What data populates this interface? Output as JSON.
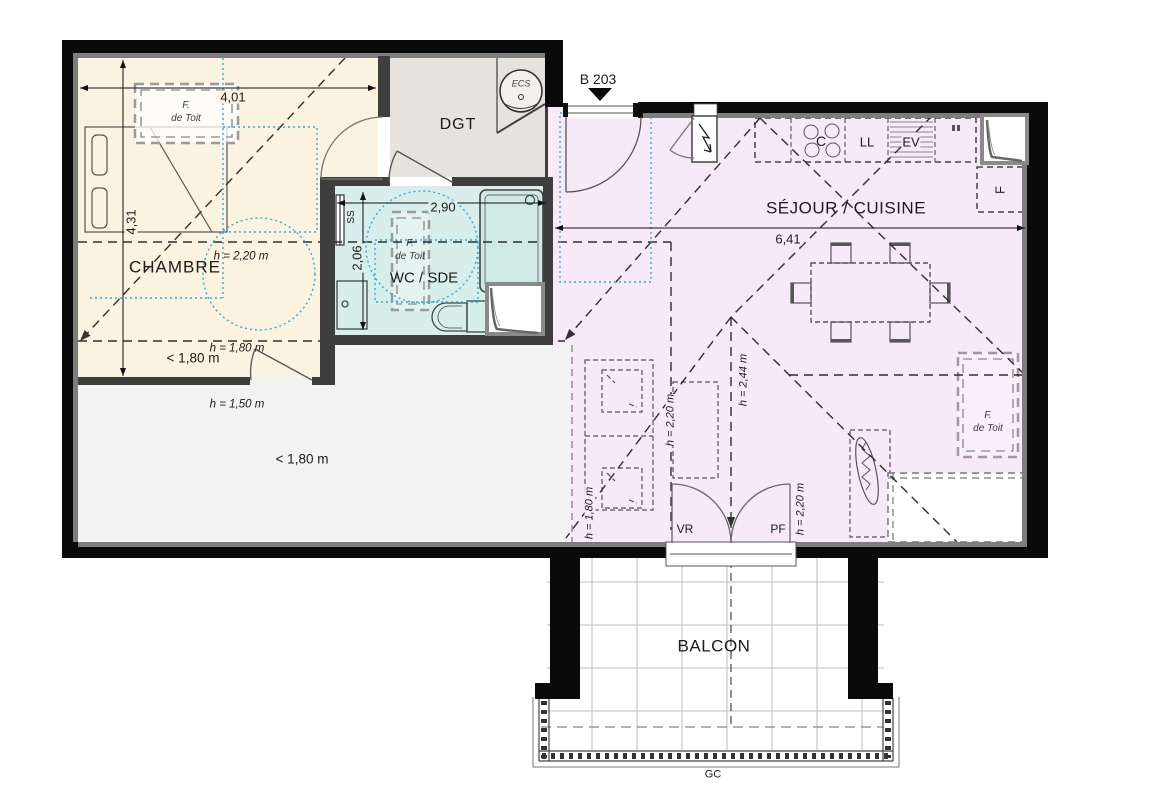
{
  "unit_label": "B 203",
  "rooms": {
    "chambre": "CHAMBRE",
    "degagement": "DGT",
    "wc_sde": "WC / SDE",
    "sejour_cuisine": "SÉJOUR / CUISINE",
    "balcon": "BALCON"
  },
  "dimensions": {
    "chambre_width": "4,01",
    "chambre_length": "4,31",
    "wc_width": "2,90",
    "wc_length": "2,06",
    "sejour_width": "6,41"
  },
  "heights": {
    "chambre_circle": "h = 2,20 m",
    "under_eaves_left": "< 1,80 m",
    "under_eaves_left_h": "h = 1,80 m",
    "under_eaves_mid": "h = 1,50 m",
    "under_eaves_right": "< 1,80 m",
    "sejour_left": "h = 1,80 m",
    "sejour_center_left": "h = 2,20 m",
    "sejour_ridge": "h = 2,44 m",
    "sejour_right": "h = 2,20 m"
  },
  "equipment": {
    "water_heater": "ECS",
    "towel_dryer": "SS",
    "cooktop": "C",
    "washing_machine": "LL",
    "sink": "EV",
    "fridge": "F",
    "roller_shutter": "VR",
    "french_window": "PF",
    "railing": "GC"
  },
  "roof_window": {
    "line1": "F.",
    "line2": "de Toit"
  }
}
